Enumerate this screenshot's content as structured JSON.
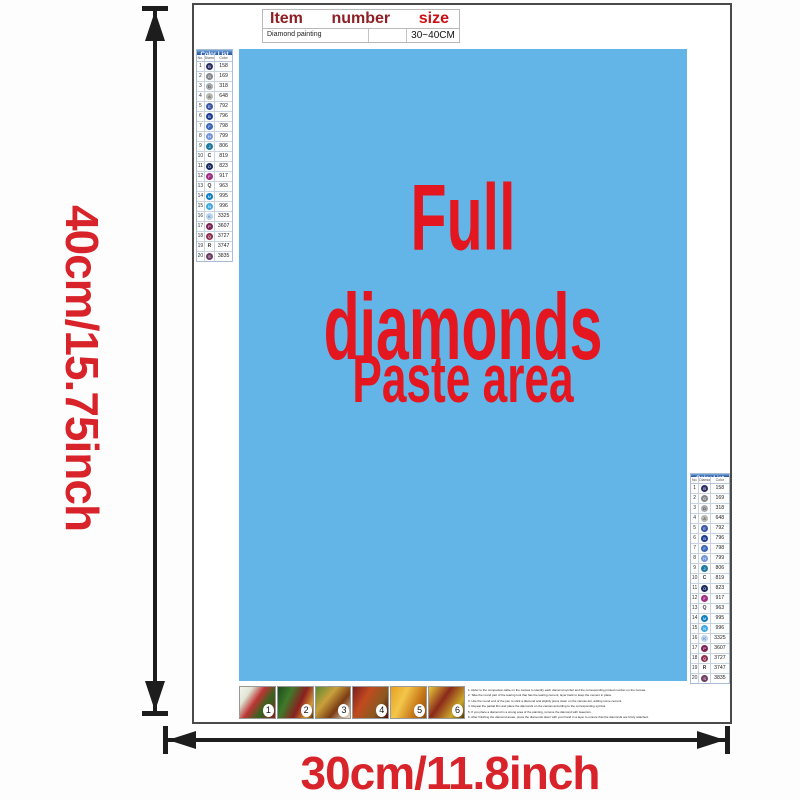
{
  "dimensions": {
    "height_label": "40cm/15.75inch",
    "width_label": "30cm/11.8inch"
  },
  "table": {
    "header_item": "Item",
    "header_number": "number",
    "header_size": "size",
    "row_item": "Diamond painting",
    "row_number": "",
    "row_size": "30~40CM"
  },
  "paste_area": {
    "line1": "Full diamonds",
    "line2": "Paste area",
    "bg_color": "#63b4e7",
    "text_color": "#e4161f"
  },
  "color_list": {
    "title": "Color List",
    "columns": [
      "No.",
      "Diamond",
      "Color"
    ],
    "rows": [
      {
        "no": "1",
        "symbol": "B",
        "code": "158",
        "circle": "#2b2f63",
        "text": "#ffffff"
      },
      {
        "no": "2",
        "symbol": "G",
        "code": "169",
        "circle": "#85878a",
        "text": "#ffffff"
      },
      {
        "no": "3",
        "symbol": "D",
        "code": "318",
        "circle": "#a9abae",
        "text": "#333333"
      },
      {
        "no": "4",
        "symbol": "A",
        "code": "648",
        "circle": "#b7b7ae",
        "text": "#444444"
      },
      {
        "no": "5",
        "symbol": "E",
        "code": "792",
        "circle": "#3b56a6",
        "text": "#ffffff"
      },
      {
        "no": "6",
        "symbol": "B",
        "code": "796",
        "circle": "#1d3d90",
        "text": "#ffffff"
      },
      {
        "no": "7",
        "symbol": "F",
        "code": "798",
        "circle": "#3a67b8",
        "text": "#ffffff"
      },
      {
        "no": "8",
        "symbol": "H",
        "code": "799",
        "circle": "#7396d6",
        "text": "#ffffff"
      },
      {
        "no": "9",
        "symbol": "J",
        "code": "806",
        "circle": "#1e7aa0",
        "text": "#ffffff"
      },
      {
        "no": "10",
        "symbol": "C",
        "code": "819",
        "circle": "none",
        "text": "#333333"
      },
      {
        "no": "11",
        "symbol": "O",
        "code": "823",
        "circle": "#1b2a5f",
        "text": "#ffffff"
      },
      {
        "no": "12",
        "symbol": "F",
        "code": "917",
        "circle": "#9e2d83",
        "text": "#ffffff"
      },
      {
        "no": "13",
        "symbol": "Q",
        "code": "963",
        "circle": "none",
        "text": "#333333"
      },
      {
        "no": "14",
        "symbol": "M",
        "code": "995",
        "circle": "#0e7fc0",
        "text": "#ffffff"
      },
      {
        "no": "15",
        "symbol": "N",
        "code": "996",
        "circle": "#41a9e1",
        "text": "#ffffff"
      },
      {
        "no": "16",
        "symbol": "K",
        "code": "3325",
        "circle": "#b9d3ee",
        "text": "#4a6a9a"
      },
      {
        "no": "17",
        "symbol": "P",
        "code": "3607",
        "circle": "#7c2355",
        "text": "#ffffff"
      },
      {
        "no": "18",
        "symbol": "Q",
        "code": "3727",
        "circle": "#8e3050",
        "text": "#ffffff"
      },
      {
        "no": "19",
        "symbol": "R",
        "code": "3747",
        "circle": "none",
        "text": "#333333"
      },
      {
        "no": "20",
        "symbol": "S",
        "code": "3835",
        "circle": "#6e3b63",
        "text": "#ffffff"
      }
    ]
  },
  "steps": {
    "numbers": [
      "1",
      "2",
      "3",
      "4",
      "5",
      "6"
    ]
  },
  "instructions_lines": [
    "1. Refer to the comparison table on the canvas to identify each diamond symbol and the corresponding printed number on the canvas.",
    "2. Take the round part of the tearing tool that has the tearing cement, layer back to keep the cement in place.",
    "3. Use the round end of the pen to stick a diamond and slightly press down on the canvas dot, adding some cement.",
    "4. Repeat the partial film and place the diamonds on the canvas according to the corresponding symbol.",
    "5. If you place a diamond in a wrong area of the painting, remove the diamond with tweezers.",
    "6. After finishing the diamond areas, press the diamonds down with your hand in a layer to ensure that the diamonds are firmly attached."
  ],
  "colors": {
    "accent_red": "#d8232a",
    "arrow_black": "#1d1d1d",
    "header_dark_red": "#8e2026",
    "size_red": "#cc1016"
  }
}
